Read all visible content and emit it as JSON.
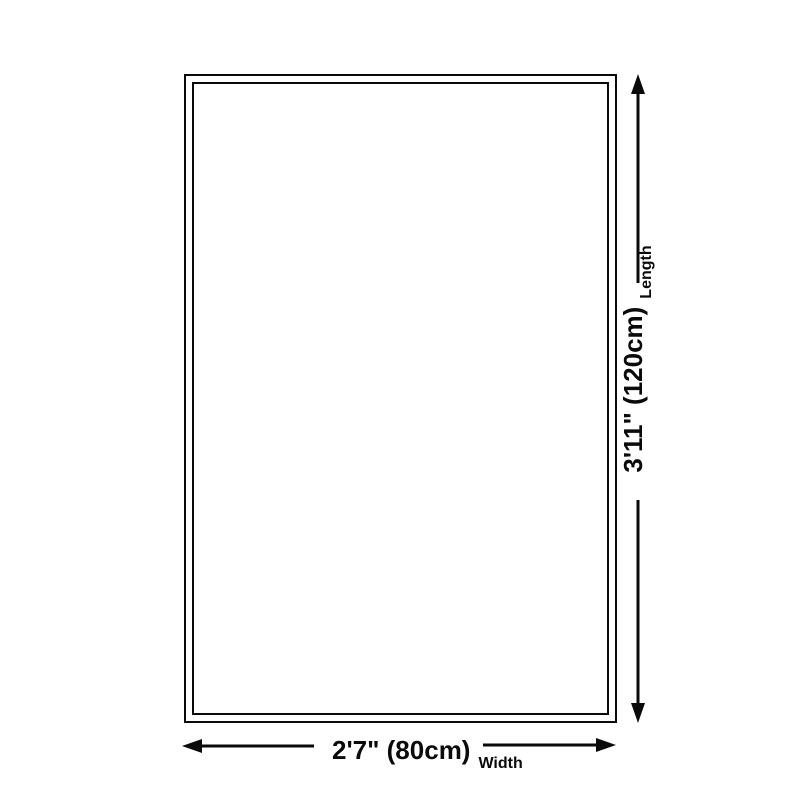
{
  "colors": {
    "background": "#ffffff",
    "outline": "#0a0a0a",
    "arrow": "#0a0a0a",
    "text": "#0a0a0a"
  },
  "rug_diagram": {
    "length": {
      "value": "3'11\" (120cm)",
      "label": "Length"
    },
    "width": {
      "value": "2'7\" (80cm)",
      "label": "Width"
    }
  }
}
